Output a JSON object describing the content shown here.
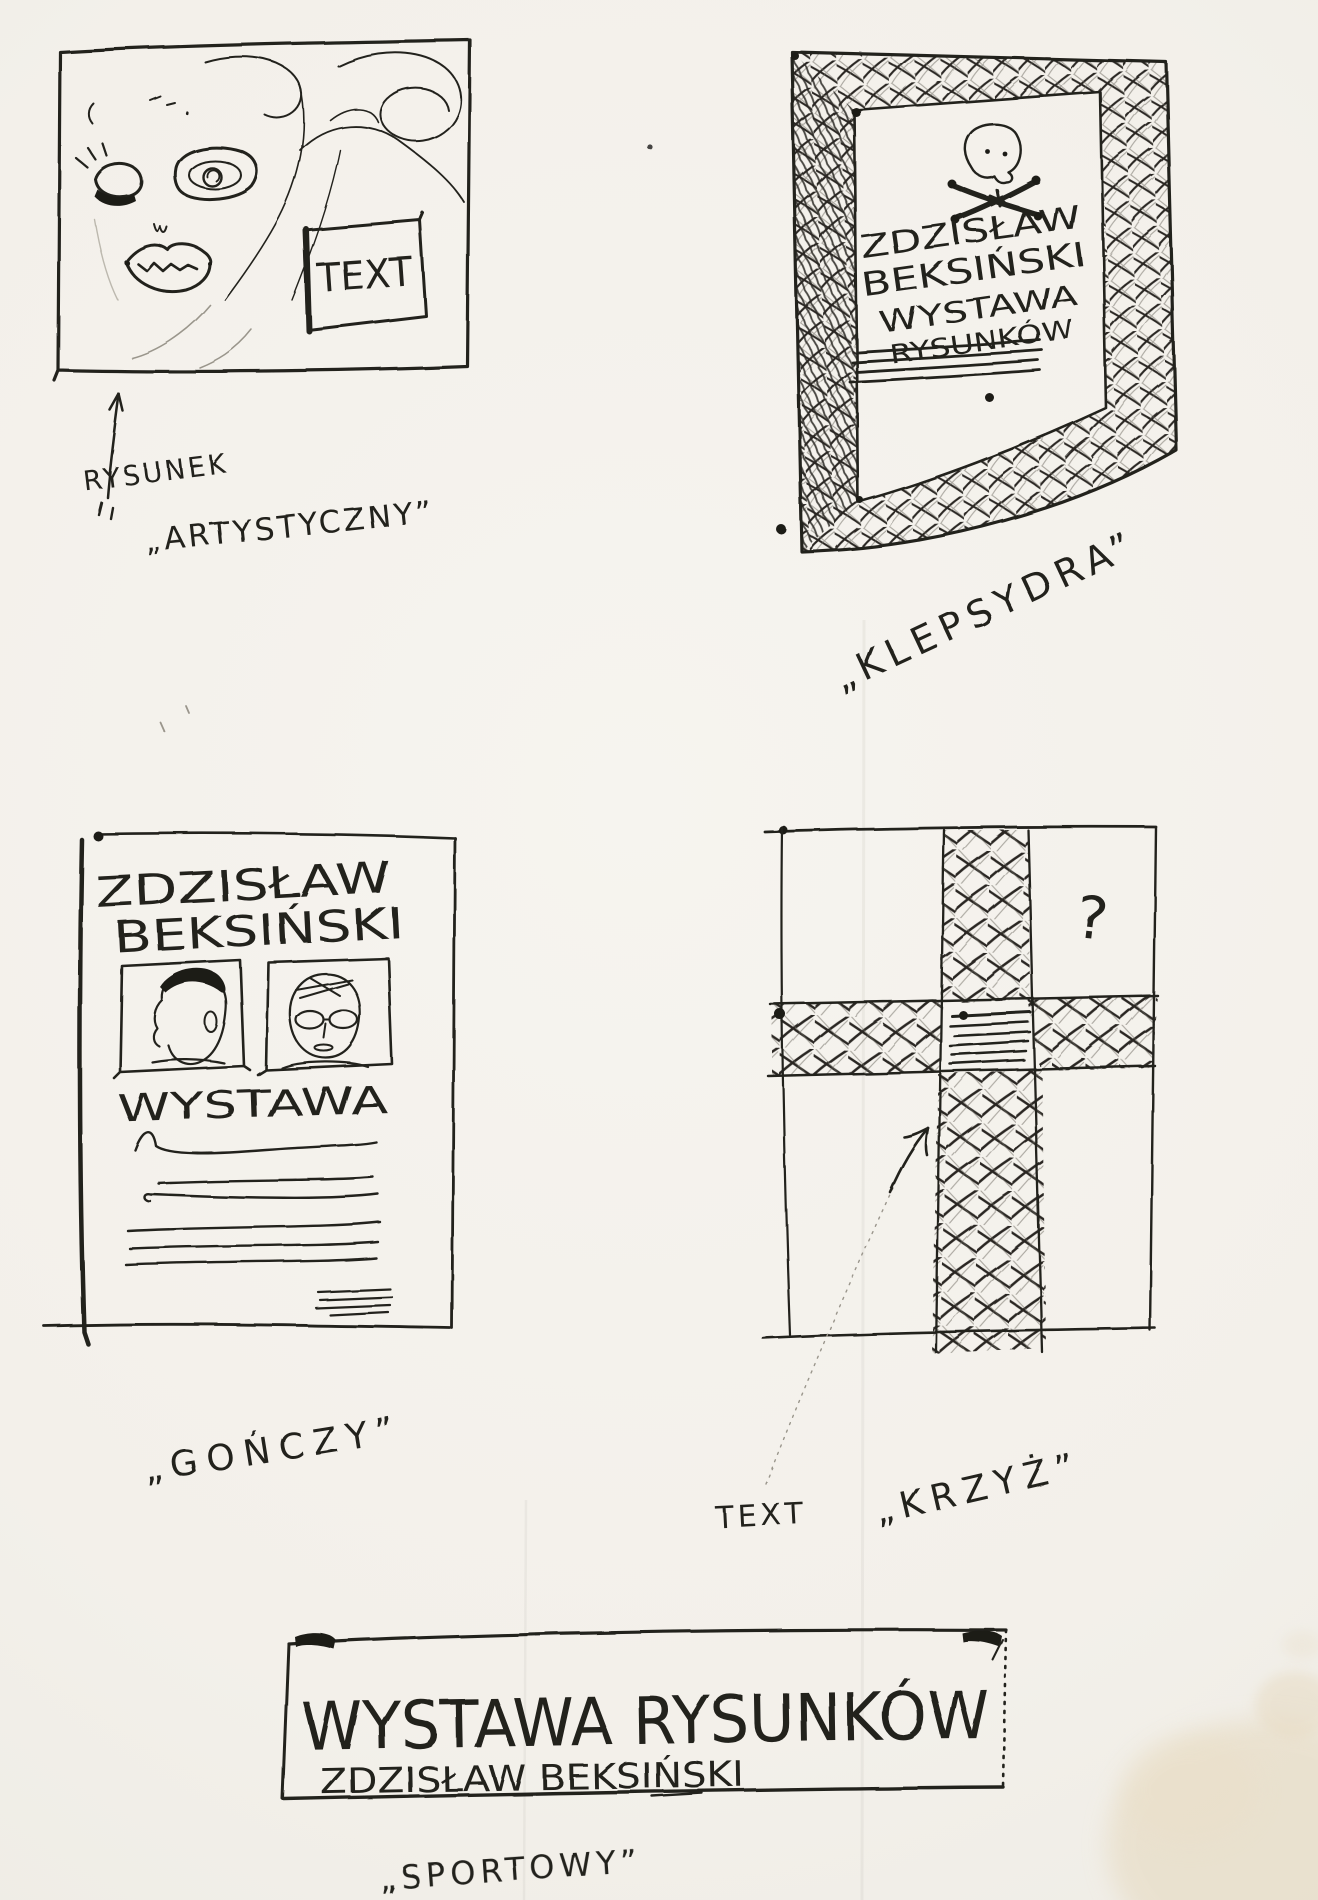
{
  "palette": {
    "paper": "#f3f0ea",
    "ink": "#24221f",
    "stain": "#e5d8bd"
  },
  "sketch_artistic": {
    "text_placeholder": "TEXT",
    "caption_line1": "RYSUNEK",
    "caption_line2": "„ARTYSTYCZNY”"
  },
  "sketch_klepsydra": {
    "poster_line1": "ZDZISŁAW",
    "poster_line2": "BEKSIŃSKI",
    "poster_line3": "WYSTAWA",
    "poster_line4": "RYSUNKÓW",
    "caption": "„KLEPSYDRA”"
  },
  "sketch_gonczy": {
    "poster_line1": "ZDZISŁAW",
    "poster_line2": "BEKSIŃSKI",
    "poster_line3": "WYSTAWA",
    "caption": "„GOŃCZY”"
  },
  "sketch_krzyz": {
    "question_mark": "?",
    "text_label": "TEXT",
    "caption": "„KRZYŻ”"
  },
  "banner_sportowy": {
    "line1": "WYSTAWA RYSUNKÓW",
    "line2": "ZDZISŁAW BEKSIŃSKI",
    "caption": "„SPORTOWY”"
  }
}
